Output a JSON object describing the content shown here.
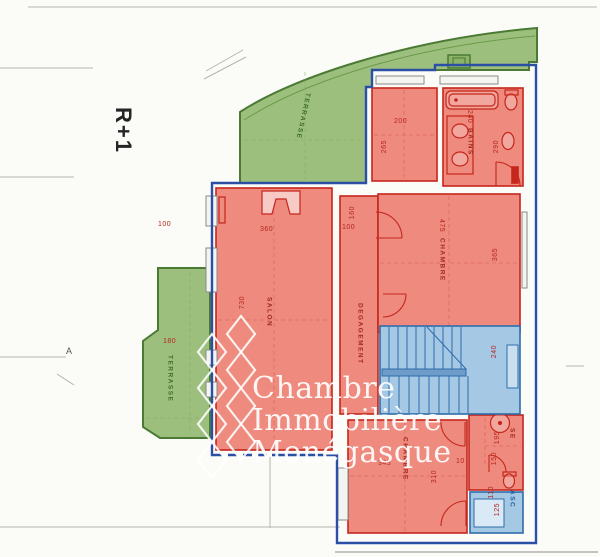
{
  "page": {
    "floor_label": "R+1",
    "section_marker": "A"
  },
  "watermark": {
    "line1": "Chambre",
    "line2": "Immobilière",
    "line3": "Monégasque"
  },
  "rooms": {
    "terrasse_top": {
      "label": "TERRASSE"
    },
    "terrasse_left": {
      "label": "TERRASSE",
      "dim_width": "180",
      "dim_return": "100"
    },
    "salon": {
      "label": "SALON",
      "dim_width": "360",
      "dim_depth": "730"
    },
    "vestibule": {
      "dim_a": "160",
      "dim_b": "100"
    },
    "dressing": {
      "dim_width": "200",
      "dim_depth": "265"
    },
    "bains": {
      "label": "BAINS",
      "dim_width": "240",
      "dim_depth": "290"
    },
    "chambre_1": {
      "label": "CHAMBRE",
      "dim_width": "475",
      "dim_depth": "365"
    },
    "degagement": {
      "label": "DEGAGEMENT"
    },
    "hall": {
      "dim_depth": "240"
    },
    "chambre_2": {
      "label": "CHAMBRE",
      "dim_width": "345",
      "dim_depth": "310",
      "dim_recess": "10"
    },
    "salle_eau": {
      "label": "SE",
      "dim_depth": "195",
      "dim_width": "150"
    },
    "ascenseur": {
      "label": "ASC",
      "dim_depth": "125",
      "dim_width": "110"
    }
  },
  "colors": {
    "terrace_fill": "#9dbf7d",
    "terrace_stroke": "#4a7a33",
    "room_fill": "#ee8a7e",
    "room_stroke": "#c6261c",
    "stairs_fill": "#a5c9e5",
    "stairs_stroke": "#2e6cab",
    "boundary": "#2b4fa5",
    "dim_text": "#b5271e",
    "terrace_text": "#3f6e2a",
    "elevator_text": "#1f5fa0"
  }
}
